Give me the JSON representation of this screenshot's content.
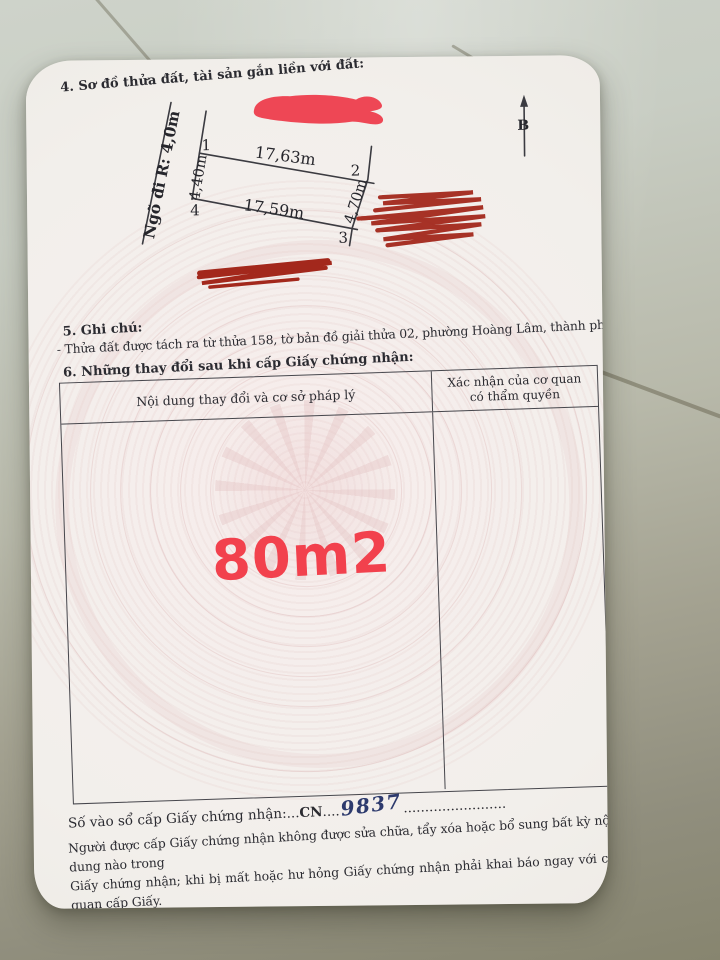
{
  "document": {
    "section4_title": "4. Sơ đồ thửa đất, tài sản gắn liền với đất:",
    "section5_title": "5. Ghi chú:",
    "section5_note": "- Thửa đất được tách ra từ thửa 158, tờ bản đồ giải thửa 02, phường Hoàng Lâm, thành phố Thủy Nguyên.",
    "section6_title": "6. Những thay đổi sau khi cấp Giấy chứng nhận:"
  },
  "diagram": {
    "alley_label": "Ngõ đi R: 4,0m",
    "north_label": "B",
    "corner1": "1",
    "corner2": "2",
    "corner3": "3",
    "corner4": "4",
    "edge_top_length": "17,63m",
    "edge_bottom_length": "17,59m",
    "edge_left_length": "4,40m",
    "edge_right_length": "4,70m"
  },
  "changes_table": {
    "col_content_header": "Nội dung thay đổi và cơ sở pháp lý",
    "col_confirm_header_line1": "Xác nhận của cơ quan",
    "col_confirm_header_line2": "có thẩm quyền",
    "area_annotation": "80m2"
  },
  "registry": {
    "label": "Số vào sổ cấp Giấy chứng nhận:",
    "leader1": "...",
    "code_prefix": "CN",
    "leader2": "....",
    "number": "9837",
    "leader3": "........................"
  },
  "warning": {
    "line1": "Người được cấp Giấy chứng nhận không được sửa chữa, tẩy xóa hoặc bổ sung bất kỳ nội dung nào trong",
    "line2": "Giấy chứng nhận; khi bị mất hoặc hư hỏng Giấy chứng nhận phải khai báo ngay với cơ quan cấp Giấy."
  },
  "colors": {
    "annotation_red": "#f2414d",
    "scribble_bright_red": "#ee3a49",
    "scribble_dark_red": "#a3281c",
    "ink_blue": "#2d3a6d",
    "line_dark": "#3b3b41",
    "paper": "#f2efeb"
  }
}
